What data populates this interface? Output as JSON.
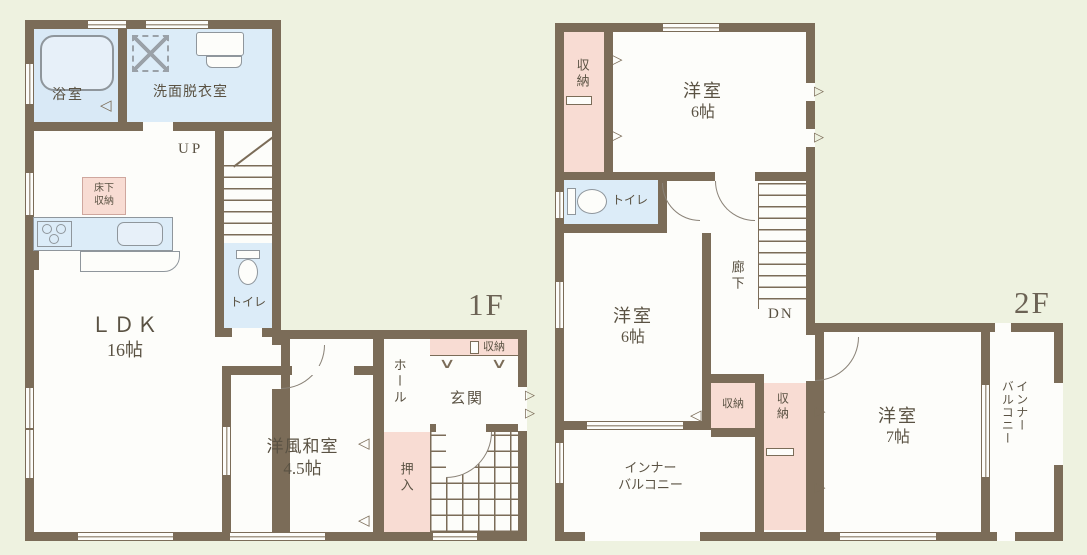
{
  "floor1": {
    "label": "1F",
    "bathroom": "浴室",
    "washroom": "洗面脱衣室",
    "underfloor_l1": "床下",
    "underfloor_l2": "収納",
    "up": "UP",
    "ldk": "ＬＤＫ",
    "ldk_size": "16帖",
    "toilet": "トイレ",
    "hall": "ホール",
    "storage": "収納",
    "entrance": "玄関",
    "washitsu": "洋風和室",
    "washitsu_size": "4.5帖",
    "oshiire": "押入"
  },
  "floor2": {
    "label": "2F",
    "closet_top": "収納",
    "bedroom_top": "洋室",
    "bedroom_top_size": "6帖",
    "toilet": "トイレ",
    "bedroom_mid": "洋室",
    "bedroom_mid_size": "6帖",
    "corridor": "廊下",
    "down": "DN",
    "closet_a": "収納",
    "closet_b": "収納",
    "balcony_l1": "インナー",
    "balcony_l2": "バルコニー",
    "bedroom_right": "洋室",
    "bedroom_right_size": "7帖",
    "balcony2_l1": "インナー",
    "balcony2_l2": "バルコニー"
  },
  "icons": {
    "door_left": "◁",
    "door_right": "▷",
    "shoe_rack_mark": "∨"
  }
}
